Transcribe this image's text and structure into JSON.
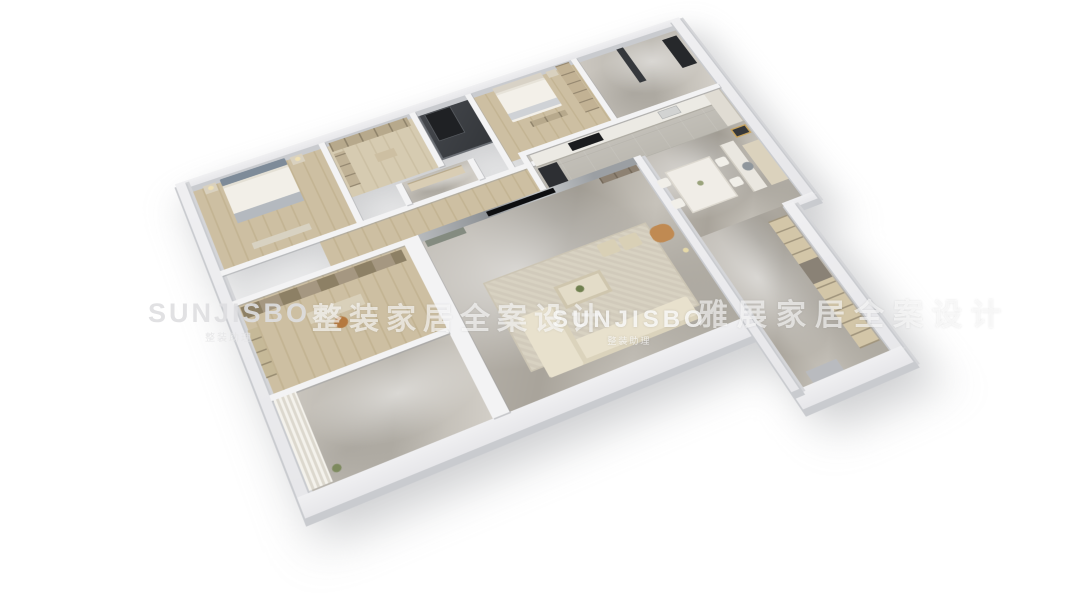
{
  "watermarks": {
    "brand": "SUNJISBO",
    "brand_subtext": "整装助理",
    "slogan_left": "整装家居全案设计",
    "slogan_right": "雅展家居全案设计"
  },
  "palette": {
    "background": "#ffffff",
    "outer_wall": "#ebebed",
    "wall_cut_face": "#c9cbcf",
    "inner_wall": "#f3f3f4",
    "marble_floor": "#b5b1a9",
    "wood_floor": "#cdbfa2",
    "dark_panel": "#3a3d41",
    "cabinet_wood": "#b7a98c",
    "sofa_cream": "#e8e1cd",
    "rug_beige": "#d6d0c0",
    "accent_tan": "#c08a52",
    "headboard_blue": "#7e8b99"
  },
  "scene": {
    "type": "3d-floorplan-render",
    "view": "axonometric dollhouse view of furnished apartment",
    "rooms": [
      {
        "id": "master-bedroom",
        "label": "Master Bedroom"
      },
      {
        "id": "walk-in-closet",
        "label": "Walk-in Closet"
      },
      {
        "id": "dark-shaft",
        "label": "Dark Shaft"
      },
      {
        "id": "guest-bedroom",
        "label": "Guest Bedroom"
      },
      {
        "id": "entry-bath",
        "label": "Entry Bathroom"
      },
      {
        "id": "corridor",
        "label": "Corridor"
      },
      {
        "id": "bathroom",
        "label": "Bathroom"
      },
      {
        "id": "study-bedroom",
        "label": "Study Bedroom"
      },
      {
        "id": "kitchen",
        "label": "Kitchen"
      },
      {
        "id": "living-room",
        "label": "Living Room"
      },
      {
        "id": "dining-area",
        "label": "Dining Area"
      },
      {
        "id": "study-nook",
        "label": "Study Nook"
      },
      {
        "id": "balcony",
        "label": "Balcony"
      },
      {
        "id": "utility-corridor",
        "label": "Utility Corridor"
      }
    ]
  }
}
